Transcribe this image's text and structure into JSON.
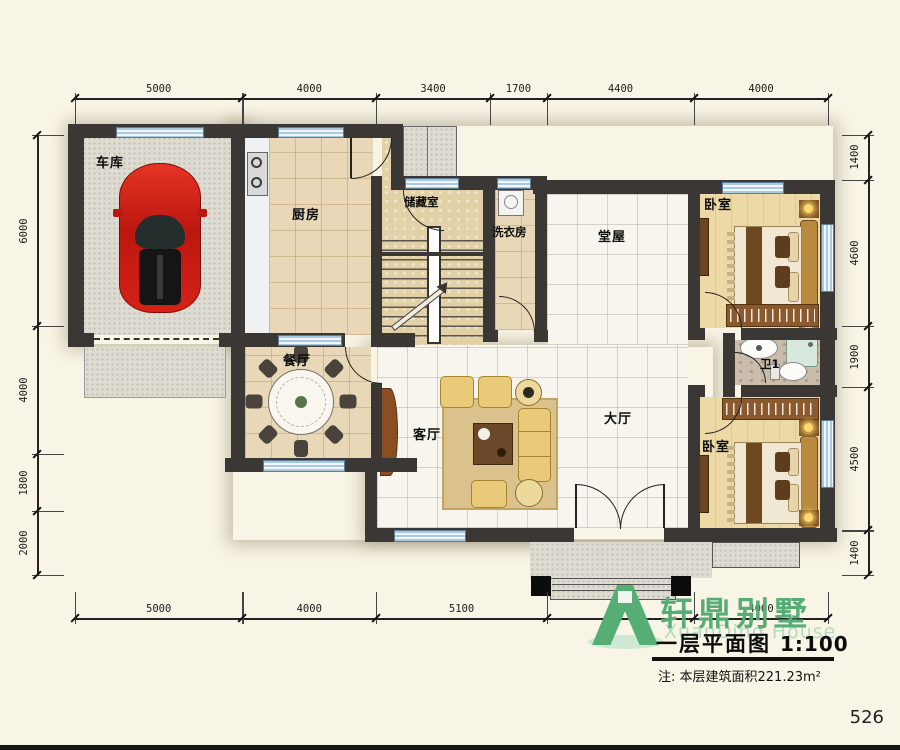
{
  "page": {
    "number": "526"
  },
  "title_block": {
    "brand": "轩鼎别墅",
    "brand_sub": "XuanDing House",
    "title": "一层平面图",
    "scale": "1:100",
    "note": "注: 本层建筑面积221.23m²"
  },
  "rooms": {
    "garage": "车库",
    "kitchen": "厨房",
    "storage": "储藏室",
    "laundry": "洗衣房",
    "central_hall": "堂屋",
    "bedroom_top": "卧室",
    "dining": "餐厅",
    "living": "客厅",
    "main_hall": "大厅",
    "bath": "卫1",
    "bedroom_bottom": "卧室"
  },
  "dimensions": {
    "top": [
      5000,
      4000,
      3400,
      1700,
      4400,
      4000
    ],
    "bottom": [
      5000,
      4000,
      5100,
      4400,
      4000
    ],
    "left": [
      6000,
      4000,
      1800,
      2000
    ],
    "right": [
      1400,
      4600,
      1900,
      4500,
      1400
    ]
  },
  "colors": {
    "background": "#f9f5e6",
    "wall": "#3b3734",
    "window_blue": "#a9cade",
    "brand_green": "#57ae74",
    "car_red": "#cc1c14"
  }
}
